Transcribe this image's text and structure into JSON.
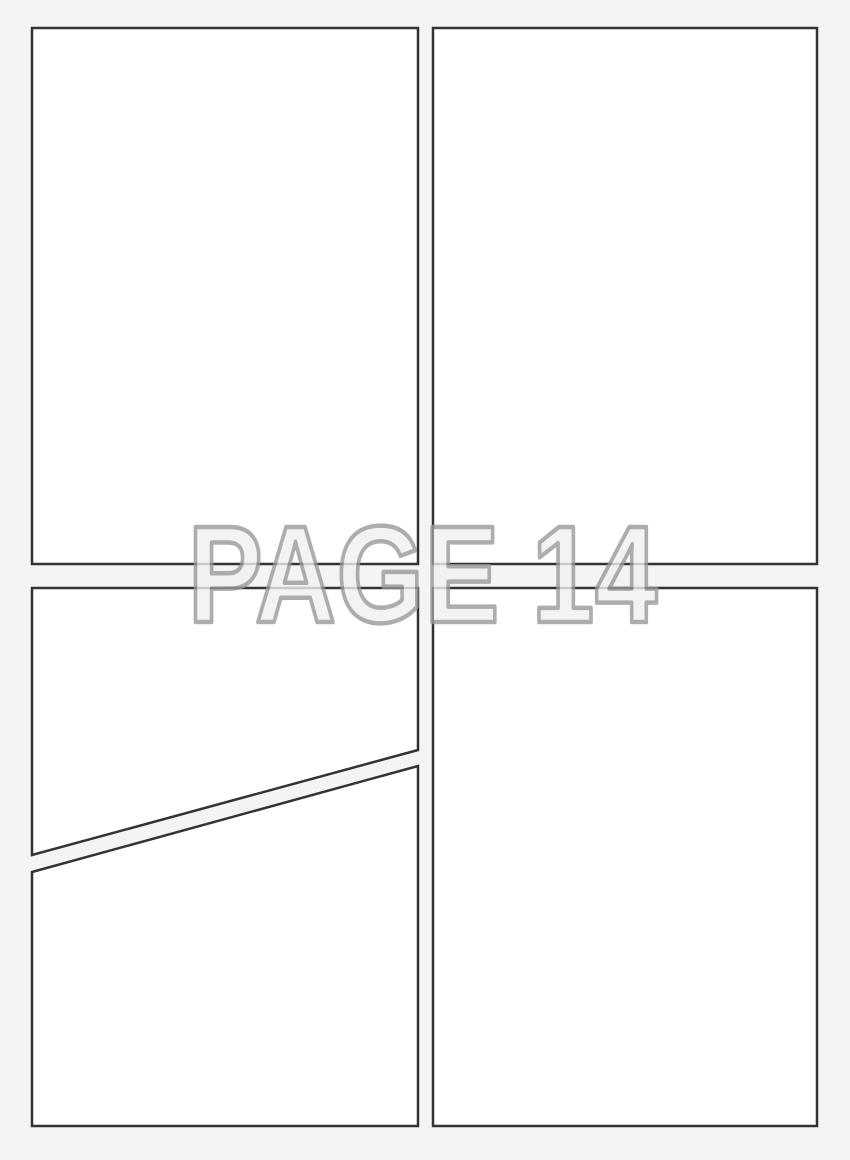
{
  "page": {
    "watermark_text": "PAGE 14"
  },
  "colors": {
    "page-bg": "#f4f4f4",
    "panel-fill": "#ffffff",
    "panel-border": "#333333",
    "watermark-fill": "#f1f1f1",
    "watermark-stroke": "#999999"
  }
}
